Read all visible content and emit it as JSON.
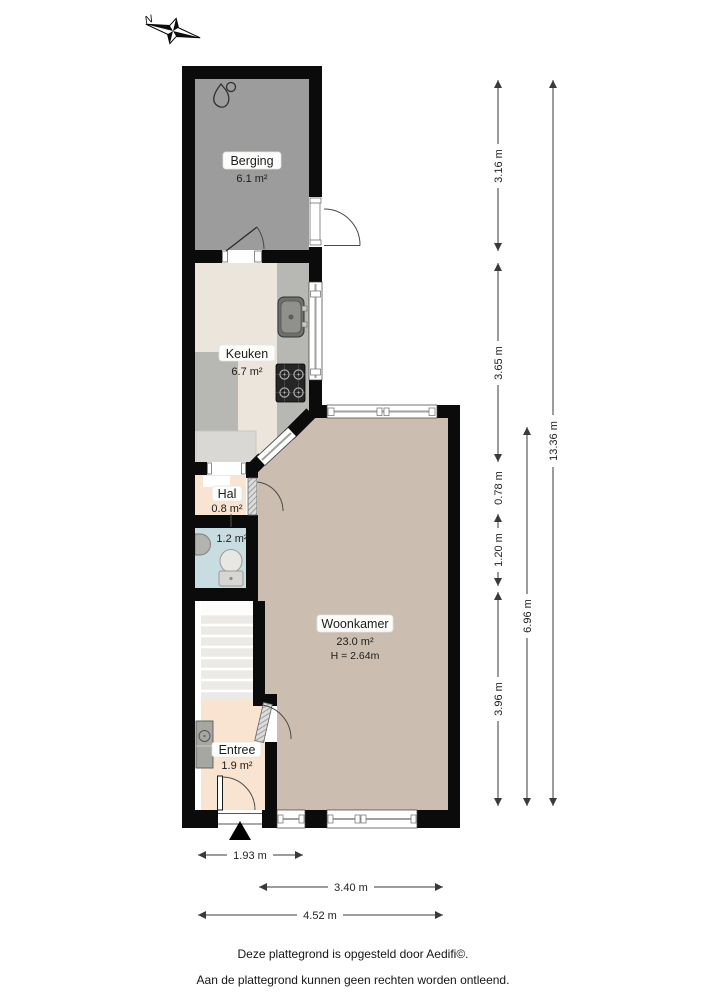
{
  "compass": {
    "label": "N"
  },
  "rooms": [
    {
      "name": "Berging",
      "area": "6.1 m²"
    },
    {
      "name": "Keuken",
      "area": "6.7 m²"
    },
    {
      "name": "Hal",
      "area": "0.8 m²"
    },
    {
      "area": "1.2 m²"
    },
    {
      "name": "Woonkamer",
      "area": "23.0 m²",
      "height": "H = 2.64m"
    },
    {
      "name": "Entree",
      "area": "1.9 m²"
    }
  ],
  "dimensions": {
    "right": [
      "3.16 m",
      "3.65 m",
      "0.78 m",
      "1.20 m",
      "3.96 m",
      "6.96 m",
      "13.36 m"
    ],
    "bottom": [
      "1.93 m",
      "3.40 m",
      "4.52 m"
    ]
  },
  "footer": {
    "line1": "Deze plattegrond is opgesteld door Aedifi©.",
    "line2": "Aan de plattegrond kunnen geen rechten worden ontleend."
  },
  "colors": {
    "wall": "#0b0b0b",
    "berging": "#9c9c9c",
    "keuken": "#ebe5dc",
    "hal": "#f8e4d0",
    "toilet": "#c8dde2",
    "woonkamer": "#cbbeb0",
    "entree": "#f8e4d0",
    "counter": "#b7b7b4"
  }
}
